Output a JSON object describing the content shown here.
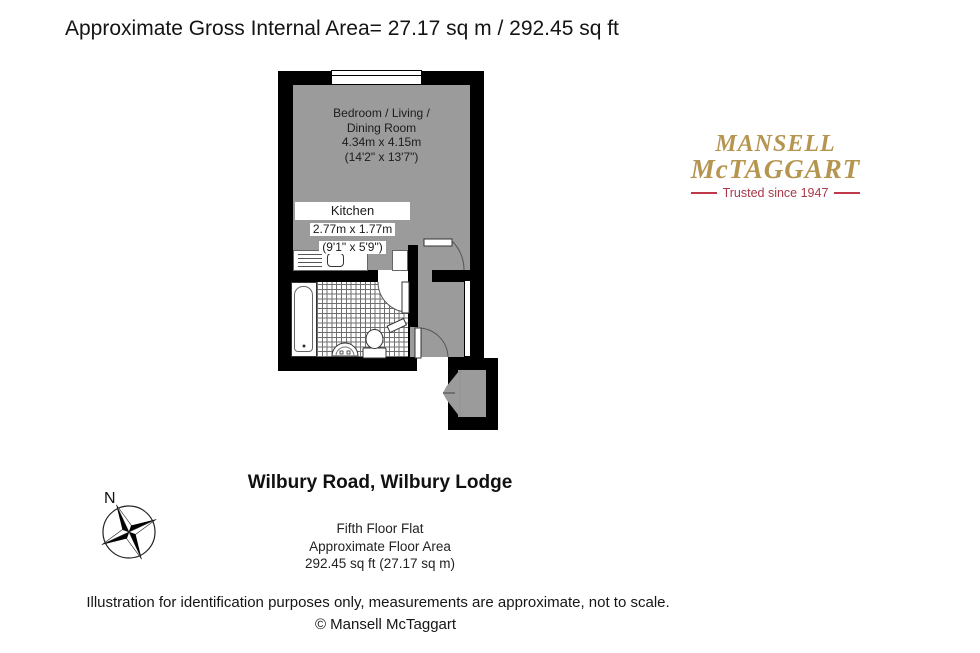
{
  "title": "Approximate Gross Internal Area= 27.17 sq m / 292.45 sq ft",
  "plan": {
    "room": {
      "name_line1": "Bedroom / Living /",
      "name_line2": "Dining Room",
      "dim_metric": "4.34m x 4.15m",
      "dim_imperial": "(14'2\" x 13'7\")"
    },
    "kitchen": {
      "name": "Kitchen",
      "dim_metric": "2.77m x 1.77m",
      "dim_imperial": "(9'1\" x 5'9\")"
    }
  },
  "logo": {
    "line1": "MANSELL",
    "line2": "McTAGGART",
    "tagline": "Trusted since 1947"
  },
  "compass": {
    "label": "N"
  },
  "address": {
    "title": "Wilbury Road, Wilbury Lodge",
    "line1": "Fifth Floor Flat",
    "line2": "Approximate Floor Area",
    "line3": "292.45 sq ft (27.17 sq m)"
  },
  "footer": {
    "disclaimer": "Illustration for identification purposes only, measurements are approximate, not to scale.",
    "copyright": "© Mansell McTaggart"
  },
  "colors": {
    "wall": "#000000",
    "floor": "#9B9B9B",
    "background": "#FFFFFF",
    "logo_gold": "#B5954F",
    "logo_red": "#A93848",
    "logo_red_dash": "#C0394B"
  }
}
